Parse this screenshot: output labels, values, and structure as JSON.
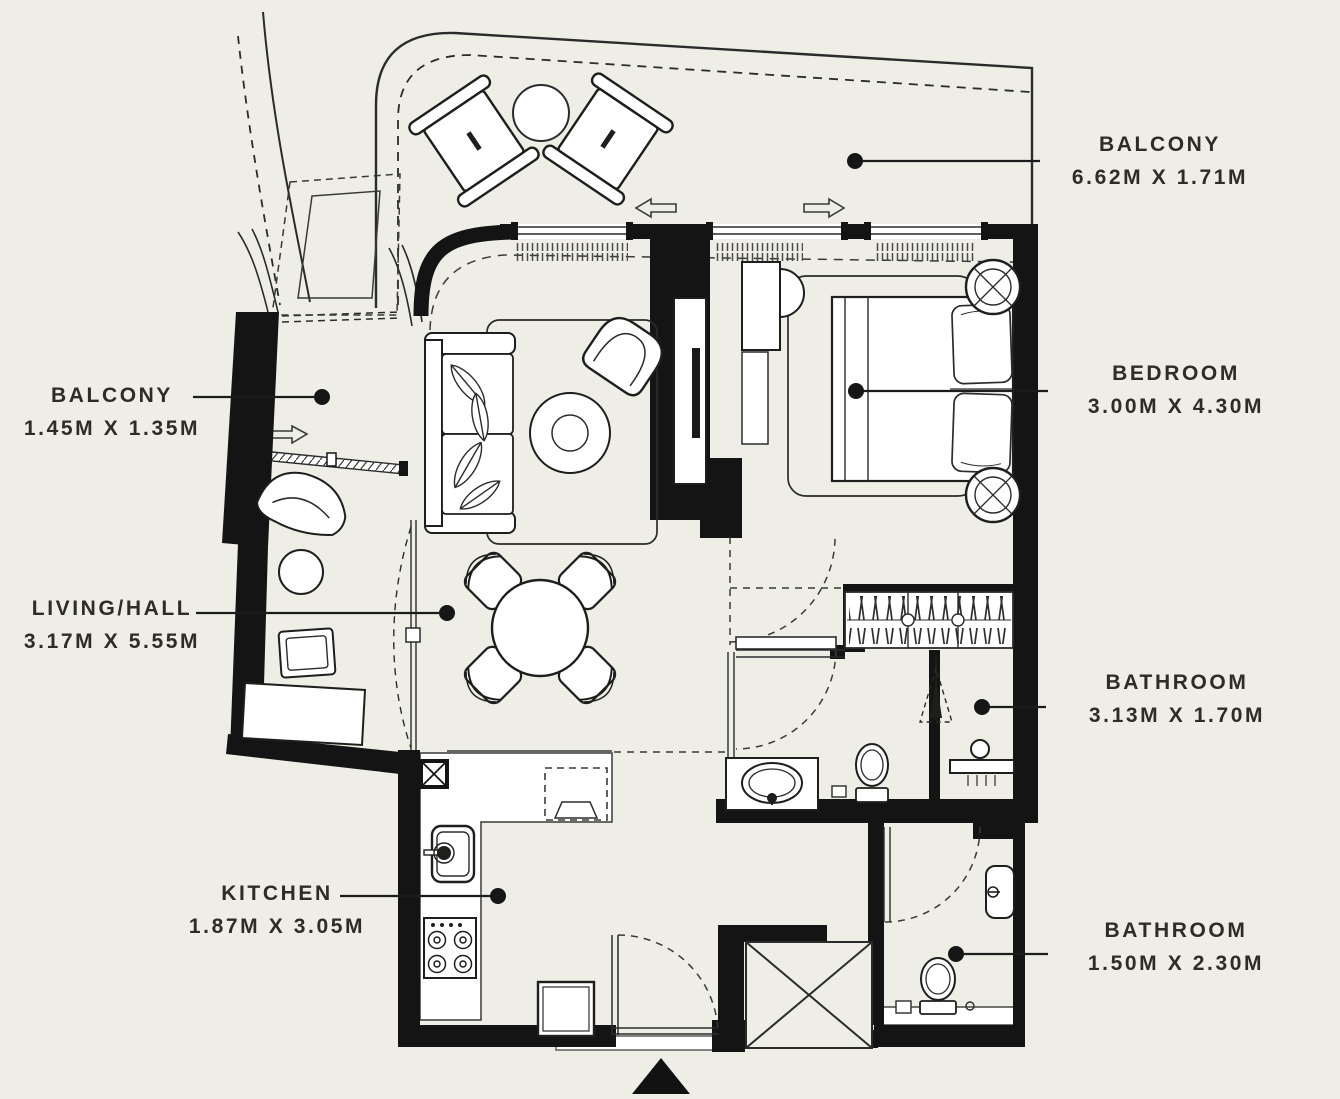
{
  "colors": {
    "background": "#efeee6",
    "walls": "#141414",
    "lines": "#2b2b2b",
    "text": "#2d2c27"
  },
  "labels": [
    {
      "id": "balcony-top",
      "title": "BALCONY",
      "dims": "6.62M X 1.71M"
    },
    {
      "id": "balcony-left",
      "title": "BALCONY",
      "dims": "1.45M X 1.35M"
    },
    {
      "id": "bedroom",
      "title": "BEDROOM",
      "dims": "3.00M X 4.30M"
    },
    {
      "id": "living-hall",
      "title": "LIVING/HALL",
      "dims": "3.17M X 5.55M"
    },
    {
      "id": "bathroom-1",
      "title": "BATHROOM",
      "dims": "3.13M X 1.70M"
    },
    {
      "id": "kitchen",
      "title": "KITCHEN",
      "dims": "1.87M X 3.05M"
    },
    {
      "id": "bathroom-2",
      "title": "BATHROOM",
      "dims": "1.50M X 2.30M"
    }
  ]
}
